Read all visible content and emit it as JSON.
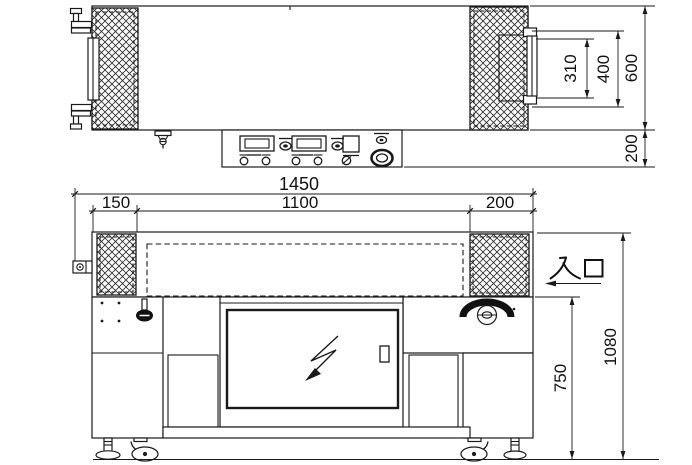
{
  "colors": {
    "line_color": "#1a1a1a",
    "background": "#ffffff"
  },
  "top_view": {
    "dimensions": {
      "d310": "310",
      "d400": "400",
      "d600": "600",
      "d200": "200"
    }
  },
  "front_view": {
    "dimensions": {
      "d1450": "1450",
      "d150": "150",
      "d1100": "1100",
      "d200": "200",
      "d750": "750",
      "d1080": "1080"
    },
    "inlet_label": "入口"
  }
}
